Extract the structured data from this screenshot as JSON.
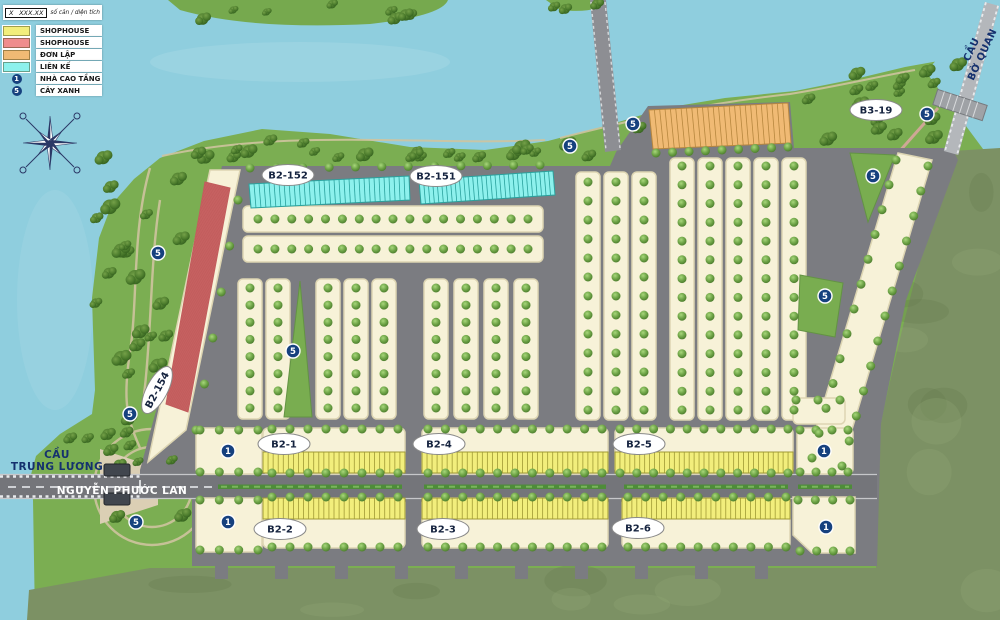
{
  "legend": {
    "sample": {
      "x_label": "X",
      "value_label": "XXX.XX",
      "caption": "số căn / diện tích"
    },
    "items": [
      {
        "kind": "swatch",
        "color": "#f2ee7c",
        "name": "shophouse-yellow",
        "label": "SHOPHOUSE"
      },
      {
        "kind": "swatch",
        "color": "#ef8d8d",
        "name": "shophouse-red",
        "label": "SHOPHOUSE"
      },
      {
        "kind": "swatch",
        "color": "#f0ba74",
        "name": "don-lap",
        "label": "ĐƠN LẬP"
      },
      {
        "kind": "swatch",
        "color": "#8df1ed",
        "name": "lien-ke",
        "label": "LIÊN KẾ"
      },
      {
        "kind": "marker",
        "symbol": "1",
        "name": "nha-cao-tang",
        "label": "NHÀ CAO TẦNG"
      },
      {
        "kind": "marker",
        "symbol": "5",
        "name": "cay-xanh",
        "label": "CÂY XANH"
      }
    ]
  },
  "map": {
    "block_labels": [
      {
        "id": "B2-152",
        "x": 288,
        "y": 175,
        "rot": 0
      },
      {
        "id": "B2-151",
        "x": 436,
        "y": 176,
        "rot": 0
      },
      {
        "id": "B3-19",
        "x": 876,
        "y": 110,
        "rot": 0
      },
      {
        "id": "B2-154",
        "x": 157,
        "y": 390,
        "rot": -62
      },
      {
        "id": "B2-1",
        "x": 284,
        "y": 444,
        "rot": 0
      },
      {
        "id": "B2-4",
        "x": 439,
        "y": 444,
        "rot": 0
      },
      {
        "id": "B2-5",
        "x": 639,
        "y": 444,
        "rot": 0
      },
      {
        "id": "B2-2",
        "x": 280,
        "y": 529,
        "rot": 0
      },
      {
        "id": "B2-3",
        "x": 443,
        "y": 529,
        "rot": 0
      },
      {
        "id": "B2-6",
        "x": 638,
        "y": 528,
        "rot": 0
      }
    ],
    "road_labels": [
      {
        "name": "CẦU TRUNG LƯƠNG",
        "lines": [
          "CẦU",
          "TRUNG LƯƠNG"
        ],
        "x": 57,
        "y": 461,
        "rot": 0,
        "color": "#15316e",
        "size": 10.5
      },
      {
        "name": "NGUYỄN PHƯỚC LAN",
        "lines": [
          "NGUYỄN PHƯỚC LAN"
        ],
        "x": 122,
        "y": 491,
        "rot": 0,
        "color": "#ffffff",
        "size": 10.5
      },
      {
        "name": "CẦU BỜ QUAN",
        "lines": [
          "CẦU",
          "BỜ QUAN"
        ],
        "x": 977,
        "y": 52,
        "rot": -65,
        "color": "#15316e",
        "size": 10
      }
    ],
    "tower_markers": [
      {
        "n": "1",
        "x": 228,
        "y": 451
      },
      {
        "n": "1",
        "x": 228,
        "y": 522
      },
      {
        "n": "1",
        "x": 824,
        "y": 451
      },
      {
        "n": "1",
        "x": 826,
        "y": 527
      }
    ],
    "green_markers": [
      {
        "n": "5",
        "x": 158,
        "y": 253
      },
      {
        "n": "5",
        "x": 130,
        "y": 414
      },
      {
        "n": "5",
        "x": 136,
        "y": 522
      },
      {
        "n": "5",
        "x": 293,
        "y": 351
      },
      {
        "n": "5",
        "x": 570,
        "y": 146
      },
      {
        "n": "5",
        "x": 633,
        "y": 124
      },
      {
        "n": "5",
        "x": 873,
        "y": 176
      },
      {
        "n": "5",
        "x": 825,
        "y": 296
      },
      {
        "n": "5",
        "x": 927,
        "y": 114
      }
    ],
    "colors": {
      "water": "#8fcede",
      "park_green": "#7bae52",
      "olive_land": "#7c9164",
      "road": "#7b7c81",
      "lot_cream": "#f7f2d8",
      "shophouse_yellow": "#f2ee7c",
      "shophouse_red": "#ef8d8d",
      "don_lap_orange": "#f0ba74",
      "lien_ke_cyan": "#8df1ed",
      "marker_navy": "#16417e"
    }
  }
}
